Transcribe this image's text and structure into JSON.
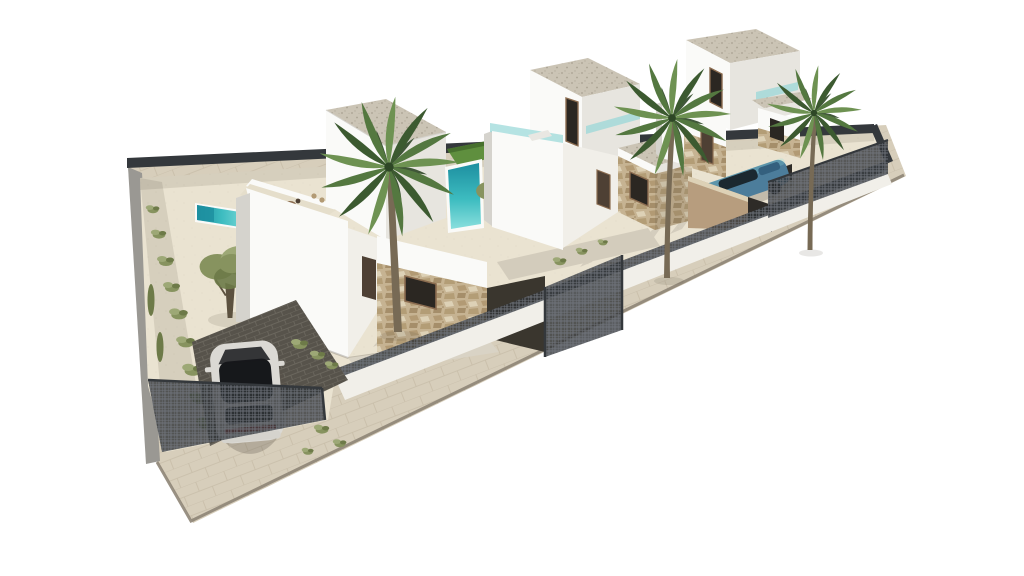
{
  "scene": {
    "type": "3d-architectural-exterior-render",
    "description": "Aerial 3D architectural rendering of a row of three modern two-storey white villas on a diagonal walled plot: left villa with roof terrace dining set, garden pool, sun loungers and olive tree; middle villa with plunge pool and lawn; right villa with a blue car on a sunken driveway; tall fan palms, stone-clad facade accents, dark mesh perimeter fencing, a silver car parked on dark grid pavers behind the entrance gate, beige sidewalk with grey curb, pure white background",
    "background": "#ffffff",
    "canvas": {
      "width": 1024,
      "height": 576
    }
  },
  "palette": {
    "background": "#ffffff",
    "sand": "#eae3d1",
    "sandShade": "#d9d0ba",
    "sidewalk": "#d7cebb",
    "sidewalkLine": "#b9ad97",
    "curb": "#8e8577",
    "wallLit": "#fafaf8",
    "wallFront": "#f1efe9",
    "wallShade": "#e7e5df",
    "wallDark": "#d5d3cd",
    "outerWall": "#9a9893",
    "gravelRoof": "#cbc4b5",
    "gravelDot": "#a9a191",
    "stoneBase": "#c6b392",
    "stoneMid": "#b29a74",
    "stoneDark": "#9c8560",
    "stoneLight": "#ddd1b6",
    "meshDarkSolid": "#34383c",
    "meshBase": "rgba(50,54,58,0.80)",
    "meshLine": "#71767c",
    "poolTeal": "#3dbcc0",
    "poolDeep": "#1d8fa0",
    "poolLight": "#8adfdd",
    "glassTeal": "rgba(150,215,215,0.70)",
    "lawn": "#5f8f3e",
    "lawnDark": "#47702e",
    "paver": "#57534b",
    "paverLine": "#6b675e",
    "palmDark": "#3c5a30",
    "palmMid": "#547840",
    "palmLight": "#6e9252",
    "palmShade": "#2e4726",
    "trunk": "#776a55",
    "trunkDark": "#5c513f",
    "olive": "#87935f",
    "oliveLight": "#9da876",
    "oliveDark": "#6d7a48",
    "windowDark": "#2b2722",
    "doorBrown": "#4e4034",
    "frameBrown": "#8a6b4f",
    "carBody": "#dbd9d4",
    "carGlass": "#16181b",
    "carTail": "#993b38",
    "carBlue": "#4c7d9b",
    "carBlueDark": "#34607e",
    "carBlueGlass": "#1b2830",
    "rampWall": "#b79d7e",
    "rampDark": "#2e2b27",
    "passage": "#3a362e",
    "walkway": "#d9d3c5",
    "apron": "#d3ccbc",
    "terraceFloor": "#e5decb",
    "loungerWhite": "#e9e7e2",
    "binGreen": "#3f6b39",
    "shadow": "rgba(90,84,72,0.28)",
    "shadowSoft": "rgba(90,84,72,0.14)",
    "stripeShadow": "rgba(58,53,48,0.12)"
  },
  "objects": [
    "villa-left",
    "villa-middle",
    "villa-right",
    "pool-left",
    "pool-middle",
    "lawn-middle",
    "palm-tree-left",
    "palm-tree-middle",
    "palm-tree-right",
    "olive-tree-left",
    "olive-tree-middle",
    "hedge-left",
    "roof-terrace-dining-set",
    "sun-loungers",
    "roof-lounger",
    "white-car",
    "blue-car",
    "parking-pavers",
    "driveway-gate",
    "entrance-gate-middle",
    "perimeter-wall",
    "back-fence",
    "front-fence",
    "right-fence",
    "driveway-ramp-wall",
    "sidewalk",
    "curb",
    "shrub-tufts"
  ]
}
